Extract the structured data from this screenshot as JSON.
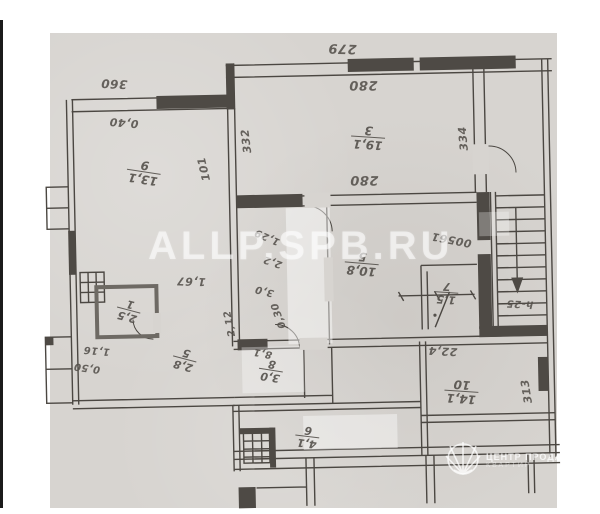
{
  "watermark": {
    "text": "ALLP.SPB.RU"
  },
  "logo": {
    "line1": "ЦЕНТР ПРОДАЖИ",
    "line2": "КВАРТИР"
  },
  "colors": {
    "scan_bg": "#d7d4d0",
    "wall": "#4b4742",
    "ink": "#55514c",
    "watermark": "rgba(255,255,255,0.55)"
  },
  "plan": {
    "orientation_note": "scan rotated 180deg",
    "dim_labels": [
      {
        "t": "279",
        "x": 347,
        "y": 49,
        "r": 183,
        "s": 13
      },
      {
        "t": "280",
        "x": 367,
        "y": 86,
        "r": 181,
        "s": 13
      },
      {
        "t": "280",
        "x": 366,
        "y": 181,
        "r": 181,
        "s": 13
      },
      {
        "t": "360",
        "x": 118,
        "y": 80,
        "r": 184,
        "s": 12
      },
      {
        "t": "0,40",
        "x": 127,
        "y": 119,
        "r": 186,
        "s": 11
      },
      {
        "t": "332",
        "x": 249,
        "y": 140,
        "r": 264,
        "s": 11
      },
      {
        "t": "334",
        "x": 466,
        "y": 142,
        "r": 266,
        "s": 11
      },
      {
        "t": "101",
        "x": 206,
        "y": 167,
        "r": 258,
        "s": 11
      },
      {
        "t": "00561",
        "x": 452,
        "y": 243,
        "r": 192,
        "s": 11
      },
      {
        "t": "1,67",
        "x": 191,
        "y": 279,
        "r": 183,
        "s": 11
      },
      {
        "t": "2,12",
        "x": 229,
        "y": 322,
        "r": 260,
        "s": 10
      },
      {
        "t": "1,29",
        "x": 268,
        "y": 236,
        "r": 205,
        "s": 10
      },
      {
        "t": "2,2",
        "x": 273,
        "y": 261,
        "r": 200,
        "s": 10
      },
      {
        "t": "3,0",
        "x": 264,
        "y": 290,
        "r": 195,
        "s": 10
      },
      {
        "t": "0,30",
        "x": 278,
        "y": 315,
        "r": 252,
        "s": 10
      },
      {
        "t": "1,16",
        "x": 95,
        "y": 346,
        "r": 186,
        "s": 10
      },
      {
        "t": "0,50",
        "x": 85,
        "y": 363,
        "r": 189,
        "s": 10
      },
      {
        "t": "22,4",
        "x": 441,
        "y": 354,
        "r": 184,
        "s": 11
      },
      {
        "t": "313",
        "x": 524,
        "y": 396,
        "r": 262,
        "s": 11
      },
      {
        "t": "h-25",
        "x": 519,
        "y": 308,
        "r": 184,
        "s": 10
      },
      {
        "t": "8,1",
        "x": 261,
        "y": 352,
        "r": 192,
        "s": 10
      }
    ],
    "room_fractions": [
      {
        "t": "13,1",
        "b": "9",
        "x": 146,
        "y": 169,
        "r": 190,
        "s": 12
      },
      {
        "t": "19,1",
        "b": "3",
        "x": 371,
        "y": 139,
        "r": 185,
        "s": 12
      },
      {
        "t": "10,8",
        "b": "5",
        "x": 362,
        "y": 265,
        "r": 186,
        "s": 12
      },
      {
        "t": "1,5",
        "b": "7",
        "x": 446,
        "y": 296,
        "r": 185,
        "s": 11
      },
      {
        "t": "14,1",
        "b": "10",
        "x": 459,
        "y": 395,
        "r": 185,
        "s": 12
      },
      {
        "t": "3,0",
        "b": "8",
        "x": 269,
        "y": 370,
        "r": 190,
        "s": 11
      },
      {
        "t": "2,8",
        "b": "5",
        "x": 183,
        "y": 357,
        "r": 196,
        "s": 11
      },
      {
        "t": "2,5",
        "b": "1",
        "x": 128,
        "y": 307,
        "r": 196,
        "s": 11
      },
      {
        "t": "4,1",
        "b": "6",
        "x": 304,
        "y": 437,
        "r": 188,
        "s": 11
      }
    ]
  }
}
